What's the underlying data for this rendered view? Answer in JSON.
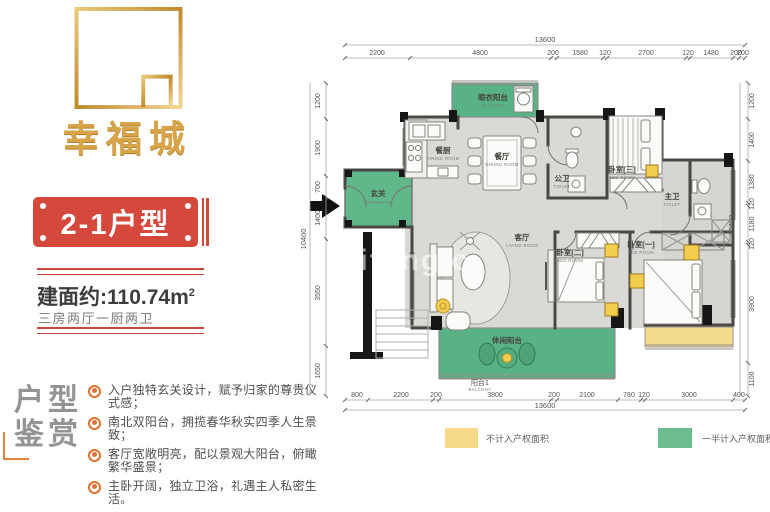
{
  "brand": {
    "name": "幸福城"
  },
  "banner": {
    "label": "2-1户型"
  },
  "area": {
    "prefix": "建面约:",
    "value": "110.74",
    "unit_base": "m",
    "unit_sup": "2",
    "layout": "三房两厅一厨两卫"
  },
  "appreciation": {
    "title_line1": "户型",
    "title_line2": "鉴赏",
    "bullets": [
      "入户独特玄关设计，赋予归家的尊贵仪式感；",
      "南北双阳台，拥揽春华秋实四季人生景致；",
      "客厅宽敞明亮，配以景观大阳台，俯瞰繁华盛景；",
      "主卧开阔，独立卫浴，礼遇主人私密生活。"
    ]
  },
  "plan": {
    "watermark": "meifang.c",
    "rooms": {
      "entrance": {
        "zh": "玄关",
        "en": "ENTRANCE"
      },
      "kitchen": {
        "zh": "餐厨",
        "en": "DINING ROOM"
      },
      "dining": {
        "zh": "餐厅",
        "en": "DINING ROOM"
      },
      "living": {
        "zh": "客厅",
        "en": "LIVING ROOM"
      },
      "toilet_public": {
        "zh": "公卫",
        "en": "TOILET"
      },
      "toilet_master": {
        "zh": "主卫",
        "en": "TOILET"
      },
      "bedroom1": {
        "zh": "卧室[一]",
        "en": "BED ROOM"
      },
      "bedroom2": {
        "zh": "卧室[二]",
        "en": "BED ROOM"
      },
      "bedroom3": {
        "zh": "卧室[三]",
        "en": "BED ROOM"
      },
      "balcony_top": {
        "zh": "晾衣阳台",
        "en": "BALCONY"
      },
      "balcony_bottom": {
        "zh": "休闲阳台",
        "en": ""
      }
    },
    "dims": {
      "top": {
        "overall": "13600",
        "segments": [
          "2200",
          "4800",
          "200",
          "1580",
          "120",
          "2700",
          "120",
          "1480",
          "200",
          "200"
        ]
      },
      "bottom": {
        "overall": "13600",
        "segments": [
          "800",
          "2200",
          "200",
          "3800",
          "200",
          "2100",
          "780",
          "120",
          "3000",
          "400"
        ],
        "balcony_zh": "阳台1",
        "balcony_en": "BALCONY"
      },
      "left": {
        "overall": "10400",
        "segments": [
          "1200",
          "1900",
          "700",
          "1400",
          "3550",
          "1650"
        ]
      },
      "right": {
        "overall": "10400",
        "segments": [
          "1200",
          "1400",
          "1380",
          "120",
          "1180",
          "120",
          "3900",
          "1100"
        ]
      }
    },
    "legend": [
      {
        "color": "#f6d98a",
        "label": "不计入产权面积"
      },
      {
        "color": "#6bbc90",
        "label": "一半计入产权面积"
      }
    ]
  }
}
